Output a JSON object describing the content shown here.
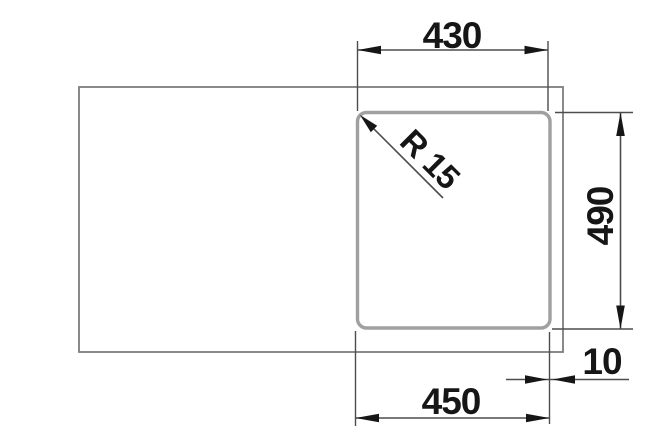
{
  "drawing": {
    "labels": {
      "width_top": "430",
      "depth_right": "490",
      "width_bottom": "450",
      "offset_right": "10",
      "corner_radius": "R 15"
    },
    "colors": {
      "background": "#ffffff",
      "outline": "#7e7e7e",
      "bowl_outline": "#a0a0a0",
      "dimension_line": "#4d4d4d",
      "arrow": "#161616",
      "text": "#161616"
    }
  }
}
